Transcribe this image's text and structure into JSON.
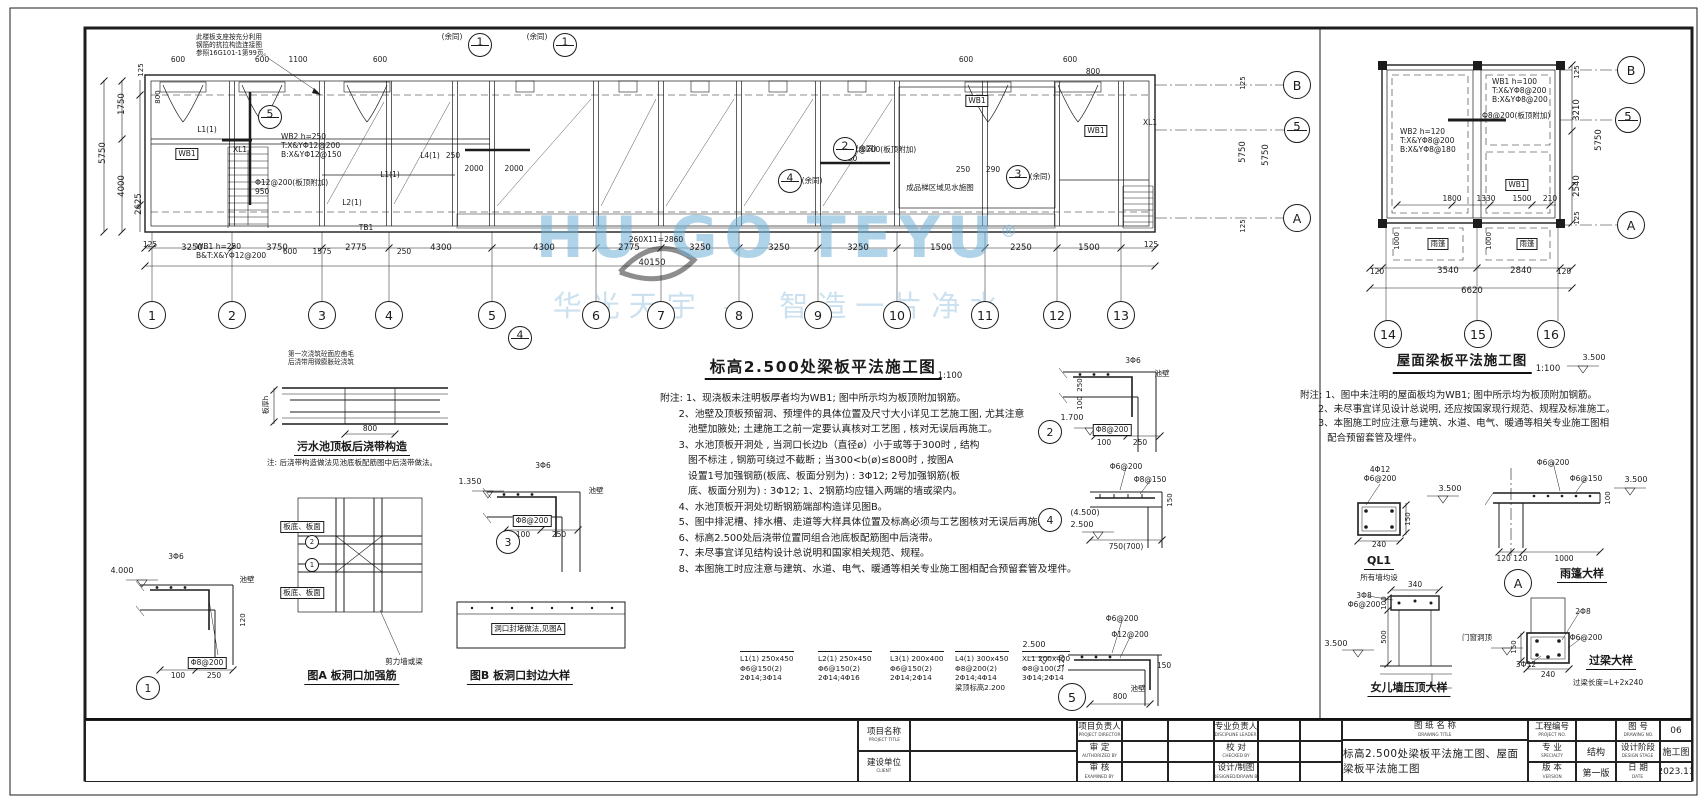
{
  "watermark": {
    "brand": "HU GO TEYU",
    "reg": "®",
    "tagline": "华光天宇 — 智造一片净水"
  },
  "plan_main": {
    "title": "标高2.500处梁板平法施工图",
    "scale": "1:100",
    "total": "40150",
    "grid_cols": [
      "1",
      "2",
      "3",
      "4",
      "5",
      "6",
      "7",
      "8",
      "9",
      "10",
      "11",
      "12",
      "13"
    ],
    "notes": [
      "附注: 1、现浇板未注明板厚者均为WB1; 图中所示均为板顶附加钢筋。",
      "      2、池壁及顶板预留洞、预埋件的具体位置及尺寸大小详见工艺施工图, 尤其注意",
      "         池壁加腋处; 土建施工之前一定要认真核对工艺图 , 核对无误后再施工。",
      "      3、水池顶板开洞处 , 当洞口长边b（直径ø）小于或等于300时 , 结构",
      "         图不标注 , 钢筋可绕过不截断 ; 当300<b(ø)≤800时 , 按图A",
      "         设置1号加强钢筋(板底、板面分别为) : 3Φ12; 2号加强钢筋(板",
      "         底、板面分别为) : 3Φ12; 1、2钢筋均应锚入两端的墙或梁内。",
      "      4、水池顶板开洞处切断钢筋端部构造详见图B。",
      "      5、图中排泥槽、排水槽、走道等大样具体位置及标高必须与工艺图核对无误后再施工。",
      "      6、标高2.500处后浇带位置同组合池底板配筋图中后浇带。",
      "      7、未尽事宜详见结构设计总说明和国家相关规范、规程。",
      "      8、本图施工时应注意与建筑、水道、电气、暖通等相关专业施工图相配合预留套管及埋件。"
    ]
  },
  "plan_roof": {
    "title": "屋面梁板平法施工图",
    "scale": "1:100",
    "total": "6620",
    "grid_cols": [
      "14",
      "15",
      "16"
    ],
    "notes": [
      "附注: 1、图中未注明的屋面板均为WB1; 图中所示均为板顶附加钢筋。",
      "      2、未尽事宜详见设计总说明, 还应按国家现行规范、规程及标准施工。",
      "      3、本图施工时应注意与建筑、水道、电气、暖通等相关专业施工图相",
      "         配合预留套管及埋件。"
    ]
  },
  "schedule": {
    "items": [
      "L1(1) 250x450\nΦ6@150(2)\n2Φ14;3Φ14",
      "L2(1) 250x450\nΦ6@150(2)\n2Φ14;4Φ16",
      "L3(1) 200x400\nΦ6@150(2)\n2Φ14;2Φ14",
      "L4(1) 300x450\nΦ8@200(2)\n2Φ14;4Φ14\n梁顶标高2.200",
      "XL1 200x400\nΦ8@100(2)\n3Φ14;2Φ14"
    ]
  },
  "bubbles": [
    {
      "n": "1",
      "x": 152,
      "y": 315,
      "r": 13
    },
    {
      "n": "2",
      "x": 232,
      "y": 315,
      "r": 13
    },
    {
      "n": "3",
      "x": 322,
      "y": 315,
      "r": 13
    },
    {
      "n": "4",
      "x": 389,
      "y": 315,
      "r": 13
    },
    {
      "n": "5",
      "x": 492,
      "y": 315,
      "r": 13
    },
    {
      "n": "6",
      "x": 596,
      "y": 315,
      "r": 13
    },
    {
      "n": "7",
      "x": 661,
      "y": 315,
      "r": 13
    },
    {
      "n": "8",
      "x": 739,
      "y": 315,
      "r": 13
    },
    {
      "n": "9",
      "x": 818,
      "y": 315,
      "r": 13
    },
    {
      "n": "10",
      "x": 897,
      "y": 315,
      "r": 13
    },
    {
      "n": "11",
      "x": 985,
      "y": 315,
      "r": 13
    },
    {
      "n": "12",
      "x": 1057,
      "y": 315,
      "r": 13
    },
    {
      "n": "13",
      "x": 1121,
      "y": 315,
      "r": 13
    },
    {
      "n": "B",
      "x": 1297,
      "y": 85,
      "r": 13
    },
    {
      "n": "5",
      "x": 1297,
      "y": 130,
      "r": 12,
      "split": true
    },
    {
      "n": "A",
      "x": 1297,
      "y": 218,
      "r": 13
    },
    {
      "n": "14",
      "x": 1388,
      "y": 334,
      "r": 13
    },
    {
      "n": "15",
      "x": 1478,
      "y": 334,
      "r": 13
    },
    {
      "n": "16",
      "x": 1551,
      "y": 334,
      "r": 13
    },
    {
      "n": "B",
      "x": 1631,
      "y": 70,
      "r": 13
    },
    {
      "n": "5",
      "x": 1628,
      "y": 120,
      "r": 12,
      "split": true
    },
    {
      "n": "A",
      "x": 1631,
      "y": 225,
      "r": 13
    },
    {
      "n": "5",
      "x": 270,
      "y": 117,
      "r": 11,
      "split": true
    },
    {
      "n": "2",
      "x": 845,
      "y": 149,
      "r": 11,
      "split": true
    },
    {
      "n": "4",
      "x": 790,
      "y": 181,
      "r": 11,
      "split": true
    },
    {
      "n": "3",
      "x": 1018,
      "y": 177,
      "r": 11,
      "split": true
    },
    {
      "n": "1",
      "x": 480,
      "y": 45,
      "r": 11,
      "split": true
    },
    {
      "n": "1",
      "x": 565,
      "y": 45,
      "r": 11,
      "split": true
    },
    {
      "n": "4",
      "x": 520,
      "y": 338,
      "r": 11,
      "split": true
    },
    {
      "n": "1",
      "x": 148,
      "y": 688,
      "r": 11
    },
    {
      "n": "3",
      "x": 508,
      "y": 542,
      "r": 11
    },
    {
      "n": "2",
      "x": 1050,
      "y": 432,
      "r": 11
    },
    {
      "n": "4",
      "x": 1050,
      "y": 520,
      "r": 11
    },
    {
      "n": "5",
      "x": 1072,
      "y": 697,
      "r": 13
    },
    {
      "n": "A",
      "x": 1518,
      "y": 583,
      "r": 13
    },
    {
      "n": "1",
      "x": 312,
      "y": 565,
      "r": 6
    },
    {
      "n": "2",
      "x": 312,
      "y": 542,
      "r": 6
    }
  ],
  "annotations": [
    {
      "t": "此楼板支座按充分利用\n钢筋的抗拉构造连接图\n参照16G101-1第99页。",
      "x": 196,
      "y": 34,
      "cls": "lss"
    },
    {
      "t": "600",
      "x": 178,
      "y": 56,
      "cls": "s"
    },
    {
      "t": "600",
      "x": 262,
      "y": 56,
      "cls": "s"
    },
    {
      "t": "1100",
      "x": 298,
      "y": 56,
      "cls": "s"
    },
    {
      "t": "600",
      "x": 380,
      "y": 56,
      "cls": "s"
    },
    {
      "t": "(余同)",
      "x": 452,
      "y": 33,
      "cls": "s"
    },
    {
      "t": "(余同)",
      "x": 537,
      "y": 33,
      "cls": "s"
    },
    {
      "t": "600",
      "x": 966,
      "y": 56,
      "cls": "s"
    },
    {
      "t": "600",
      "x": 1070,
      "y": 56,
      "cls": "s"
    },
    {
      "t": "800",
      "x": 1093,
      "y": 68,
      "cls": "s"
    },
    {
      "t": "125",
      "x": 141,
      "y": 70,
      "cls": "vs"
    },
    {
      "t": "1750",
      "x": 122,
      "y": 104,
      "cls": "v"
    },
    {
      "t": "5750",
      "x": 103,
      "y": 153,
      "cls": "v"
    },
    {
      "t": "4000",
      "x": 122,
      "y": 186,
      "cls": "v"
    },
    {
      "t": "2625",
      "x": 139,
      "y": 204,
      "cls": "v"
    },
    {
      "t": "800",
      "x": 158,
      "y": 97,
      "cls": "vs"
    },
    {
      "t": "L1(1)",
      "x": 207,
      "y": 126,
      "cls": "s"
    },
    {
      "t": "WB1",
      "x": 187,
      "y": 148,
      "cls": "b"
    },
    {
      "t": "XL1",
      "x": 240,
      "y": 146,
      "cls": "s"
    },
    {
      "t": "WB2 h=250\nT:X&YΦ12@200\nB:X&YΦ12@150",
      "x": 281,
      "y": 133,
      "cls": "ls"
    },
    {
      "t": "Φ12@200(板顶附加)\n950",
      "x": 255,
      "y": 179,
      "cls": "ls"
    },
    {
      "t": "L2(1)",
      "x": 352,
      "y": 199,
      "cls": "s"
    },
    {
      "t": "L1(1)",
      "x": 390,
      "y": 171,
      "cls": "s"
    },
    {
      "t": "L4(1)",
      "x": 430,
      "y": 152,
      "cls": "s"
    },
    {
      "t": "250",
      "x": 453,
      "y": 152,
      "cls": "s"
    },
    {
      "t": "2000",
      "x": 474,
      "y": 165,
      "cls": "s"
    },
    {
      "t": "2000",
      "x": 514,
      "y": 165,
      "cls": "s"
    },
    {
      "t": "Φ12@200(板顶附加)\n950",
      "x": 843,
      "y": 146,
      "cls": "ls"
    },
    {
      "t": "WB1",
      "x": 977,
      "y": 95,
      "cls": "b"
    },
    {
      "t": "250",
      "x": 963,
      "y": 166,
      "cls": "s"
    },
    {
      "t": "290",
      "x": 993,
      "y": 166,
      "cls": "s"
    },
    {
      "t": "WB1",
      "x": 1096,
      "y": 125,
      "cls": "b"
    },
    {
      "t": "XL1",
      "x": 1150,
      "y": 119,
      "cls": "s"
    },
    {
      "t": "TB1",
      "x": 366,
      "y": 224,
      "cls": "s"
    },
    {
      "t": "成品梯区域见水施图",
      "x": 940,
      "y": 184,
      "cls": "s"
    },
    {
      "t": "(余同)",
      "x": 866,
      "y": 145,
      "cls": "s"
    },
    {
      "t": "(余同)",
      "x": 812,
      "y": 177,
      "cls": "s"
    },
    {
      "t": "(余同)",
      "x": 1040,
      "y": 173,
      "cls": "s"
    },
    {
      "t": "WB1 h=250\nB&T:X&YΦ12@200",
      "x": 196,
      "y": 243,
      "cls": "ls"
    },
    {
      "t": "600",
      "x": 290,
      "y": 248,
      "cls": "s"
    },
    {
      "t": "1575",
      "x": 322,
      "y": 248,
      "cls": "s"
    },
    {
      "t": "250",
      "x": 404,
      "y": 248,
      "cls": "s"
    },
    {
      "t": "260X11=2860",
      "x": 656,
      "y": 236,
      "cls": "s"
    },
    {
      "t": "125",
      "x": 150,
      "y": 241,
      "cls": "s"
    },
    {
      "t": "125",
      "x": 1151,
      "y": 241,
      "cls": "s"
    },
    {
      "t": "3250",
      "x": 192,
      "y": 243,
      "cls": "c"
    },
    {
      "t": "3750",
      "x": 277,
      "y": 243,
      "cls": "c"
    },
    {
      "t": "2775",
      "x": 356,
      "y": 243,
      "cls": "c"
    },
    {
      "t": "4300",
      "x": 441,
      "y": 243,
      "cls": "c"
    },
    {
      "t": "4300",
      "x": 544,
      "y": 243,
      "cls": "c"
    },
    {
      "t": "2775",
      "x": 629,
      "y": 243,
      "cls": "c"
    },
    {
      "t": "3250",
      "x": 700,
      "y": 243,
      "cls": "c"
    },
    {
      "t": "3250",
      "x": 779,
      "y": 243,
      "cls": "c"
    },
    {
      "t": "3250",
      "x": 858,
      "y": 243,
      "cls": "c"
    },
    {
      "t": "1500",
      "x": 941,
      "y": 243,
      "cls": "c"
    },
    {
      "t": "2250",
      "x": 1021,
      "y": 243,
      "cls": "c"
    },
    {
      "t": "1500",
      "x": 1089,
      "y": 243,
      "cls": "c"
    },
    {
      "t": "40150",
      "x": 652,
      "y": 258,
      "cls": "c"
    },
    {
      "t": "5750",
      "x": 1243,
      "y": 152,
      "cls": "v"
    },
    {
      "t": "5750",
      "x": 1266,
      "y": 155,
      "cls": "v"
    },
    {
      "t": "125",
      "x": 1243,
      "y": 83,
      "cls": "vs"
    },
    {
      "t": "125",
      "x": 1243,
      "y": 226,
      "cls": "vs"
    },
    {
      "t": "标高2.500处梁板平法施工图",
      "x": 823,
      "y": 358,
      "cls": "t1"
    },
    {
      "t": "1:100",
      "x": 950,
      "y": 371,
      "cls": "c"
    },
    {
      "t": "第一次浇筑砼面应凿毛\n后浇带用微膨胀砼浇筑",
      "x": 288,
      "y": 351,
      "cls": "lss"
    },
    {
      "t": "板厚h",
      "x": 266,
      "y": 405,
      "cls": "vs"
    },
    {
      "t": "800",
      "x": 370,
      "y": 425,
      "cls": "s"
    },
    {
      "t": "污水池顶板后浇带构造",
      "x": 352,
      "y": 441,
      "cls": "t3"
    },
    {
      "t": "注: 后浇带构造做法见池底板配筋图中后浇带做法。",
      "x": 352,
      "y": 459,
      "cls": "s"
    },
    {
      "t": "4.000",
      "x": 122,
      "y": 566,
      "cls": "lvl"
    },
    {
      "t": "3Φ6",
      "x": 176,
      "y": 553,
      "cls": "s"
    },
    {
      "t": "池壁",
      "x": 247,
      "y": 576,
      "cls": "s"
    },
    {
      "t": "Φ8@200",
      "x": 207,
      "y": 657,
      "cls": "b"
    },
    {
      "t": "100",
      "x": 178,
      "y": 672,
      "cls": "s"
    },
    {
      "t": "250",
      "x": 214,
      "y": 672,
      "cls": "s"
    },
    {
      "t": "120",
      "x": 243,
      "y": 620,
      "cls": "vs"
    },
    {
      "t": "1.350",
      "x": 470,
      "y": 477,
      "cls": "lvl"
    },
    {
      "t": "3Φ6",
      "x": 543,
      "y": 462,
      "cls": "s"
    },
    {
      "t": "池壁",
      "x": 596,
      "y": 487,
      "cls": "s"
    },
    {
      "t": "Φ8@200",
      "x": 532,
      "y": 515,
      "cls": "b"
    },
    {
      "t": "100",
      "x": 523,
      "y": 531,
      "cls": "s"
    },
    {
      "t": "250",
      "x": 559,
      "y": 531,
      "cls": "s"
    },
    {
      "t": "板底、板面",
      "x": 302,
      "y": 521,
      "cls": "b"
    },
    {
      "t": "板底、板面",
      "x": 302,
      "y": 587,
      "cls": "b"
    },
    {
      "t": "剪力墙或梁",
      "x": 404,
      "y": 658,
      "cls": "s"
    },
    {
      "t": "图A 板洞口加强筋",
      "x": 352,
      "y": 670,
      "cls": "t3"
    },
    {
      "t": "洞口封堵做法,见图A",
      "x": 528,
      "y": 623,
      "cls": "b"
    },
    {
      "t": "图B 板洞口封边大样",
      "x": 520,
      "y": 670,
      "cls": "t3"
    },
    {
      "t": "1.700",
      "x": 1072,
      "y": 413,
      "cls": "lvl"
    },
    {
      "t": "3Φ6",
      "x": 1133,
      "y": 357,
      "cls": "s"
    },
    {
      "t": "池壁",
      "x": 1162,
      "y": 370,
      "cls": "s"
    },
    {
      "t": "Φ8@200",
      "x": 1112,
      "y": 424,
      "cls": "b"
    },
    {
      "t": "100",
      "x": 1104,
      "y": 439,
      "cls": "s"
    },
    {
      "t": "250",
      "x": 1140,
      "y": 439,
      "cls": "s"
    },
    {
      "t": "250",
      "x": 1080,
      "y": 385,
      "cls": "vs"
    },
    {
      "t": "100",
      "x": 1080,
      "y": 403,
      "cls": "vs"
    },
    {
      "t": "(4.500)",
      "x": 1085,
      "y": 508,
      "cls": "lvl"
    },
    {
      "t": "2.500",
      "x": 1082,
      "y": 520,
      "cls": "lvl"
    },
    {
      "t": "Φ6@200",
      "x": 1126,
      "y": 463,
      "cls": "s"
    },
    {
      "t": "Φ8@150",
      "x": 1150,
      "y": 476,
      "cls": "s"
    },
    {
      "t": "750(700)",
      "x": 1126,
      "y": 543,
      "cls": "s"
    },
    {
      "t": "150",
      "x": 1170,
      "y": 500,
      "cls": "vs"
    },
    {
      "t": "2.500",
      "x": 1034,
      "y": 640,
      "cls": "lvl"
    },
    {
      "t": "Φ6@200",
      "x": 1122,
      "y": 615,
      "cls": "s"
    },
    {
      "t": "Φ12@200",
      "x": 1130,
      "y": 631,
      "cls": "s"
    },
    {
      "t": "120",
      "x": 1062,
      "y": 661,
      "cls": "vs"
    },
    {
      "t": "800",
      "x": 1120,
      "y": 693,
      "cls": "s"
    },
    {
      "t": "150",
      "x": 1164,
      "y": 662,
      "cls": "s"
    },
    {
      "t": "池壁",
      "x": 1138,
      "y": 685,
      "cls": "s"
    },
    {
      "t": "WB1 h=100\nT:X&YΦ8@200\nB:X&YΦ8@200",
      "x": 1492,
      "y": 78,
      "cls": "ls"
    },
    {
      "t": "Φ8@200(板顶附加)",
      "x": 1482,
      "y": 112,
      "cls": "ls"
    },
    {
      "t": "WB2 h=120\nT:X&YΦ8@200\nB:X&YΦ8@180",
      "x": 1400,
      "y": 128,
      "cls": "ls"
    },
    {
      "t": "WB1",
      "x": 1517,
      "y": 179,
      "cls": "b"
    },
    {
      "t": "1800",
      "x": 1452,
      "y": 195,
      "cls": "s"
    },
    {
      "t": "1330",
      "x": 1486,
      "y": 195,
      "cls": "s"
    },
    {
      "t": "1500",
      "x": 1522,
      "y": 195,
      "cls": "s"
    },
    {
      "t": "210",
      "x": 1550,
      "y": 195,
      "cls": "s"
    },
    {
      "t": "1000",
      "x": 1397,
      "y": 241,
      "cls": "vs"
    },
    {
      "t": "1000",
      "x": 1489,
      "y": 241,
      "cls": "vs"
    },
    {
      "t": "雨篷",
      "x": 1438,
      "y": 238,
      "cls": "b"
    },
    {
      "t": "雨篷",
      "x": 1527,
      "y": 238,
      "cls": "b"
    },
    {
      "t": "120",
      "x": 1377,
      "y": 268,
      "cls": "s"
    },
    {
      "t": "3540",
      "x": 1448,
      "y": 266,
      "cls": "c"
    },
    {
      "t": "2840",
      "x": 1521,
      "y": 266,
      "cls": "c"
    },
    {
      "t": "120",
      "x": 1564,
      "y": 268,
      "cls": "s"
    },
    {
      "t": "6620",
      "x": 1472,
      "y": 286,
      "cls": "c"
    },
    {
      "t": "125",
      "x": 1577,
      "y": 72,
      "cls": "vs"
    },
    {
      "t": "3210",
      "x": 1577,
      "y": 110,
      "cls": "v"
    },
    {
      "t": "5750",
      "x": 1599,
      "y": 140,
      "cls": "v"
    },
    {
      "t": "2540",
      "x": 1577,
      "y": 186,
      "cls": "v"
    },
    {
      "t": "125",
      "x": 1577,
      "y": 218,
      "cls": "vs"
    },
    {
      "t": "屋面梁板平法施工图",
      "x": 1462,
      "y": 354,
      "cls": "t2"
    },
    {
      "t": "1:100",
      "x": 1548,
      "y": 364,
      "cls": "c"
    },
    {
      "t": "3.500",
      "x": 1594,
      "y": 353,
      "cls": "lvl"
    },
    {
      "t": "4Φ12\nΦ6@200",
      "x": 1380,
      "y": 466,
      "cls": "s"
    },
    {
      "t": "3.500",
      "x": 1450,
      "y": 484,
      "cls": "lvl"
    },
    {
      "t": "150",
      "x": 1408,
      "y": 519,
      "cls": "vs"
    },
    {
      "t": "240",
      "x": 1379,
      "y": 541,
      "cls": "s"
    },
    {
      "t": "QL1",
      "x": 1379,
      "y": 555,
      "cls": "t3"
    },
    {
      "t": "所有墙均设",
      "x": 1379,
      "y": 574,
      "cls": "s"
    },
    {
      "t": "Φ6@200",
      "x": 1553,
      "y": 459,
      "cls": "s"
    },
    {
      "t": "Φ6@150",
      "x": 1586,
      "y": 475,
      "cls": "s"
    },
    {
      "t": "3.500",
      "x": 1636,
      "y": 475,
      "cls": "lvl"
    },
    {
      "t": "100",
      "x": 1608,
      "y": 498,
      "cls": "vs"
    },
    {
      "t": "120 120",
      "x": 1512,
      "y": 555,
      "cls": "s"
    },
    {
      "t": "1000",
      "x": 1564,
      "y": 555,
      "cls": "s"
    },
    {
      "t": "雨篷大样",
      "x": 1582,
      "y": 568,
      "cls": "t3"
    },
    {
      "t": "3Φ8\nΦ6@200",
      "x": 1364,
      "y": 592,
      "cls": "s"
    },
    {
      "t": "340",
      "x": 1415,
      "y": 581,
      "cls": "s"
    },
    {
      "t": "100",
      "x": 1384,
      "y": 603,
      "cls": "vs"
    },
    {
      "t": "500",
      "x": 1384,
      "y": 637,
      "cls": "vs"
    },
    {
      "t": "3.500",
      "x": 1336,
      "y": 639,
      "cls": "lvl"
    },
    {
      "t": "女儿墙压顶大样",
      "x": 1409,
      "y": 682,
      "cls": "t3"
    },
    {
      "t": "2Φ8",
      "x": 1583,
      "y": 608,
      "cls": "s"
    },
    {
      "t": "Φ6@200",
      "x": 1586,
      "y": 634,
      "cls": "s"
    },
    {
      "t": "3Φ12",
      "x": 1526,
      "y": 661,
      "cls": "s"
    },
    {
      "t": "门窗洞顶",
      "x": 1477,
      "y": 634,
      "cls": "s"
    },
    {
      "t": "150",
      "x": 1514,
      "y": 647,
      "cls": "vs"
    },
    {
      "t": "240",
      "x": 1548,
      "y": 671,
      "cls": "s"
    },
    {
      "t": "过梁大样",
      "x": 1611,
      "y": 655,
      "cls": "t3"
    },
    {
      "t": "过梁长度=L+2x240",
      "x": 1608,
      "y": 679,
      "cls": "s"
    }
  ],
  "titleblock": {
    "project_title": {
      "cn": "项目名称",
      "en": "PROJECT TITLE"
    },
    "client": {
      "cn": "建设单位",
      "en": "CLIENT"
    },
    "pm": {
      "cn": "项目负责人",
      "en": "PROJECT DIRECTOR"
    },
    "approved": {
      "cn": "审 定",
      "en": "AUTHORIZED BY"
    },
    "examined": {
      "cn": "审 核",
      "en": "EXAMINED BY"
    },
    "disc_lead": {
      "cn": "专业负责人",
      "en": "DISCIPLINE LEADER"
    },
    "checked": {
      "cn": "校 对",
      "en": "CHECKED BY"
    },
    "designed": {
      "cn": "设计/制图",
      "en": "DESIGNED/DRAWN BY"
    },
    "dwg_title_label": {
      "cn": "图 纸 名 称",
      "en": "DRAWING TITLE"
    },
    "dwg_title": "标高2.500处梁板平法施工图、屋面梁板平法施工图",
    "proj_no": {
      "cn": "工程编号",
      "en": "PROJECT NO.",
      "value": ""
    },
    "specialty": {
      "cn": "专 业",
      "en": "SPECIALTY",
      "value": "结构"
    },
    "version": {
      "cn": "版 本",
      "en": "VERSION",
      "value": "第一版"
    },
    "dwg_no": {
      "cn": "图 号",
      "en": "DRAWING NO.",
      "value": "06"
    },
    "stage": {
      "cn": "设计阶段",
      "en": "DESIGN STAGE",
      "value": "施工图"
    },
    "date": {
      "cn": "日 期",
      "en": "DATE",
      "value": "2023.11"
    }
  }
}
